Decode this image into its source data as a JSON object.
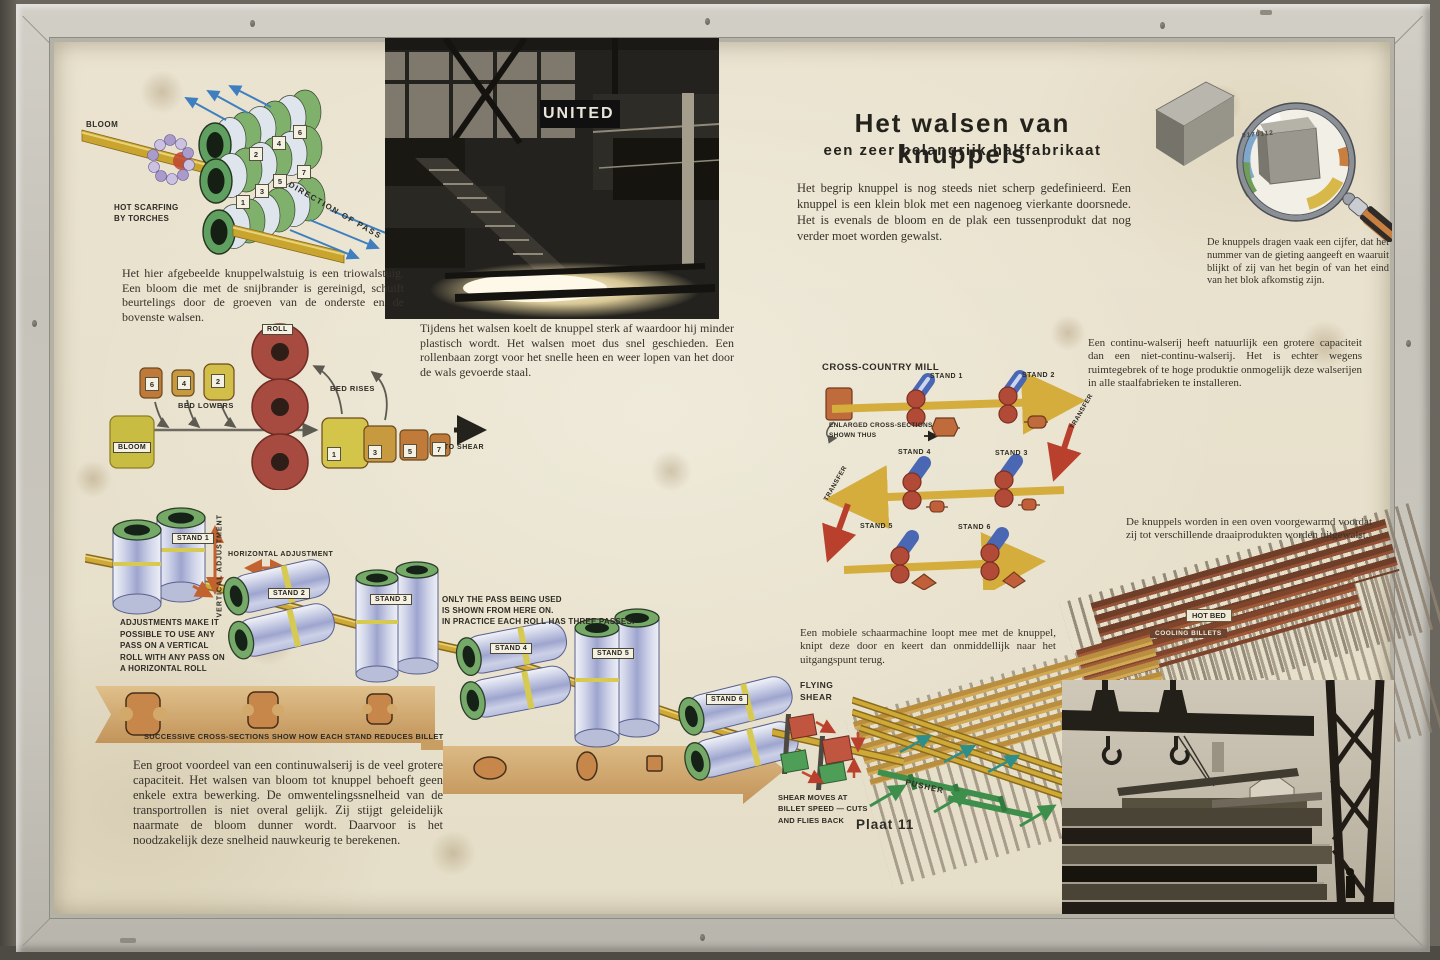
{
  "poster": {
    "title": "Het walsen van knuppels",
    "subtitle": "een zeer belangrijk halffabrikaat",
    "intro": "Het begrip knuppel is nog steeds niet scherp gedefinieerd. Een knuppel is een klein blok met een nagenoeg vierkante doorsnede. Het is evenals de bloom en de plak een tussenprodukt dat nog verder moet worden gewalst.",
    "plate_label": "Plaat 11"
  },
  "trio": {
    "bloom": "BLOOM",
    "scarfing": "HOT SCARFING\nBY TORCHES",
    "direction": "DIRECTION OF PASS",
    "numbers": [
      "1",
      "2",
      "3",
      "4",
      "5",
      "6",
      "7"
    ],
    "caption": "Het hier afgebeelde knuppelwalstuig is een triowalstuig. Een bloom die met de snijbrander is gereinigd, schuift beurtelings door de groeven van de onderste en de bovenste walsen."
  },
  "photo_mill": {
    "sign": "UNITED",
    "caption": "Tijdens het walsen koelt de knuppel sterk af waardoor hij minder plastisch wordt. Het walsen moet dus snel geschieden. Een rollenbaan zorgt voor het snelle heen en weer lopen van het door de wals gevoerde staal."
  },
  "magnifier": {
    "number": "0170112",
    "caption": "De knuppels dragen vaak een cijfer, dat het nummer van de gieting aangeeft en waaruit blijkt of zij van het begin of van het eind van het blok afkomstig zijn."
  },
  "passes": {
    "roll": "ROLL",
    "bloom": "BLOOM",
    "bed_lowers": "BED LOWERS",
    "bed_rises": "BED RISES",
    "to_shear": "TO SHEAR",
    "upper": [
      "6",
      "4",
      "2"
    ],
    "lower": [
      "1",
      "3",
      "5",
      "7"
    ]
  },
  "crosscountry": {
    "title": "CROSS-COUNTRY MILL",
    "enlarged": "ENLARGED CROSS-SECTIONS\nSHOWN THUS",
    "transfer": "TRANSFER",
    "stands": [
      "STAND 1",
      "STAND 2",
      "STAND 4",
      "STAND 3",
      "STAND 5",
      "STAND 6"
    ],
    "note": "Een continu-walserij heeft natuurlijk een grotere capaciteit dan een niet-continu-walserij. Het is echter wegens ruimtegebrek of te hoge produktie onmogelijk deze walserijen in alle staalfabrieken te installeren."
  },
  "train": {
    "stands": [
      "STAND 1",
      "STAND 2",
      "STAND 3",
      "STAND 4",
      "STAND 5",
      "STAND 6"
    ],
    "vertical": "VERTICAL ADJUSTMENT",
    "horizontal": "HORIZONTAL ADJUSTMENT",
    "adjustments": "ADJUSTMENTS MAKE IT\nPOSSIBLE TO USE ANY\nPASS ON A VERTICAL\nROLL WITH ANY PASS ON\nA HORIZONTAL ROLL",
    "pass_note": "ONLY THE PASS BEING USED\nIS SHOWN FROM HERE ON.\nIN PRACTICE EACH ROLL HAS THREE PASSES.",
    "band_caption": "SUCCESSIVE CROSS-SECTIONS SHOW HOW EACH STAND REDUCES BILLET",
    "note": "Een groot voordeel van een continuwalserij is de veel grotere capaciteit. Het walsen van bloom tot knuppel behoeft geen enkele extra bewerking. De omwentelingssnelheid van de transportrollen is niet overal gelijk. Zij stijgt geleidelijk naarmate de bloom dunner wordt. Daarvoor is het noodzakelijk deze snelheid nauwkeurig te berekenen."
  },
  "shear": {
    "flying": "FLYING\nSHEAR",
    "note": "SHEAR MOVES AT\nBILLET SPEED — CUTS\nAND FLIES BACK",
    "pusher": "PUSHER",
    "mobile_note": "Een mobiele schaarmachine loopt mee met de knuppel, knipt deze door en keert dan onmiddellijk naar het uitgangspunt terug."
  },
  "hotbed": {
    "hot_bed": "HOT BED",
    "cooling": "COOLING BILLETS",
    "note": "De knuppels worden in een oven voorgewarmd voordat zij tot verschillende draaiprodukten worden uitgewalst."
  }
}
